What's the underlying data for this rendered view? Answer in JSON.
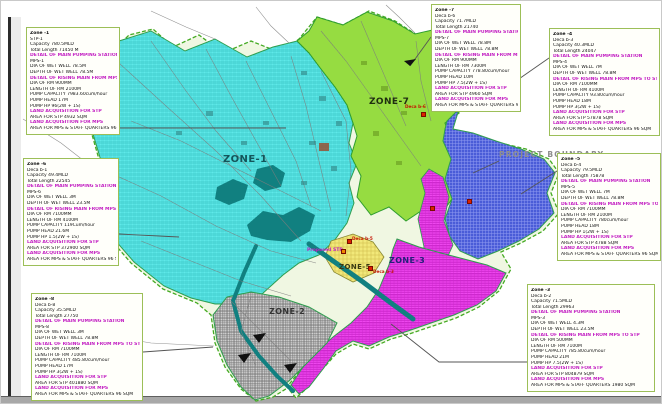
{
  "colors": {
    "zone_cyan": "#5fe9e9",
    "zone_green": "#a4e84c",
    "zone_blue": "#4a5cd8",
    "zone_magenta": "#ee46ee",
    "zone_yellow": "#f2e879",
    "zone_gray": "#cccccc",
    "water_teal": "#118080",
    "boundary_green": "#44aa22",
    "highlight_magenta": "#c21ec2",
    "marker_red": "#dd2200",
    "marker_orange": "#ee8800"
  },
  "map": {
    "project_boundary_label": "PROJECT BOUNDARY",
    "proposed_stp_label": "Proposed STP",
    "zone_labels": [
      {
        "id": "zone-1",
        "text": "ZONE-1"
      },
      {
        "id": "zone-7",
        "text": "ZONE-7"
      },
      {
        "id": "zone-2",
        "text": "ZONE-2"
      },
      {
        "id": "zone-3",
        "text": "ZONE-3"
      },
      {
        "id": "zone-5",
        "text": "ZONE-5"
      }
    ],
    "markers": [
      {
        "label": "Deca b-6",
        "type": "pump-station",
        "color": "#dd2200",
        "x": 420,
        "y": 111,
        "lx": 404,
        "ly": 103
      },
      {
        "label": "",
        "type": "pump-station",
        "color": "#dd2200",
        "x": 466,
        "y": 198,
        "lx": 0,
        "ly": 0
      },
      {
        "label": "",
        "type": "pump-station",
        "color": "#dd2200",
        "x": 429,
        "y": 205,
        "lx": 0,
        "ly": 0
      },
      {
        "label": "Deca b-3",
        "type": "pump-station",
        "color": "#dd2200",
        "x": 367,
        "y": 265,
        "lx": 372,
        "ly": 268
      },
      {
        "label": "Deca b-5",
        "type": "pump-station",
        "color": "#dd2200",
        "x": 346,
        "y": 238,
        "lx": 351,
        "ly": 235
      },
      {
        "label": "",
        "type": "proposed-stp",
        "color": "#ee8800",
        "x": 340,
        "y": 248,
        "lx": 0,
        "ly": 0
      }
    ]
  },
  "info_boxes": [
    {
      "id": "zone-1-info",
      "lines": [
        {
          "t": "Zone -1",
          "hl": false
        },
        {
          "t": "STP-1",
          "hl": false
        },
        {
          "t": "Capacity 780.5MLD",
          "hl": false
        },
        {
          "t": "Total Length 71450 M",
          "hl": false
        },
        {
          "t": "DETAIL OF MAIN PUMPING STATION",
          "hl": true
        },
        {
          "t": "MPS-1",
          "hl": false
        },
        {
          "t": "DIA OF WET WELL 78.5M",
          "hl": false
        },
        {
          "t": "DEPTH OF WET WELL 78.5M",
          "hl": false
        },
        {
          "t": "DETAIL OF RISING MAIN FROM MPS TO STP",
          "hl": true
        },
        {
          "t": "DIA OF RM 900MM",
          "hl": false
        },
        {
          "t": "LENGTH OF RM 2100M",
          "hl": false
        },
        {
          "t": "PUMP CAPACITY 7983.60cum/hour",
          "hl": false
        },
        {
          "t": "PUMP HEAD 17M",
          "hl": false
        },
        {
          "t": "PUMP HP 96(2W + 1S)",
          "hl": false
        },
        {
          "t": "LAND ACQUISITION FOR STP",
          "hl": true
        },
        {
          "t": "AREA FOR STP 4932 SQM",
          "hl": false
        },
        {
          "t": "LAND ACQUISITION FOR MPS",
          "hl": true
        },
        {
          "t": "AREA FOR MPS & STAFF QUARTERS 96 SQM",
          "hl": false
        }
      ]
    },
    {
      "id": "zone-7-info",
      "lines": [
        {
          "t": "Zone -7",
          "hl": false
        },
        {
          "t": "Deca b-6",
          "hl": false
        },
        {
          "t": "Capacity 71.7MLD",
          "hl": false
        },
        {
          "t": "Total Length 21740",
          "hl": false
        },
        {
          "t": "DETAIL OF MAIN PUMPING STATION",
          "hl": true
        },
        {
          "t": "MPS-7",
          "hl": false
        },
        {
          "t": "DIA OF WET WELL 78.8M",
          "hl": false
        },
        {
          "t": "DEPTH OF WET WELL 78.8M",
          "hl": false
        },
        {
          "t": "DETAIL OF RISING MAIN FROM MPS TO STP",
          "hl": true
        },
        {
          "t": "DIA OF RM 900MM",
          "hl": false
        },
        {
          "t": "LENGTH OF RM 7300M",
          "hl": false
        },
        {
          "t": "PUMP CAPACITY 778.80cum/hour",
          "hl": false
        },
        {
          "t": "PUMP HEAD 10M",
          "hl": false
        },
        {
          "t": "PUMP HP 7.5(2W + 1S)",
          "hl": false
        },
        {
          "t": "LAND ACQUISITION FOR STP",
          "hl": true
        },
        {
          "t": "AREA FOR STP 4960 SQM",
          "hl": false
        },
        {
          "t": "LAND ACQUISITION FOR MPS",
          "hl": true
        },
        {
          "t": "AREA FOR MPS & STAFF QUARTERS 96 SQM",
          "hl": false
        }
      ]
    },
    {
      "id": "zone-4-info",
      "lines": [
        {
          "t": "Zone -4",
          "hl": false
        },
        {
          "t": "Deca b-3",
          "hl": false
        },
        {
          "t": "Capacity 40.3MLD",
          "hl": false
        },
        {
          "t": "Total Length 24047",
          "hl": false
        },
        {
          "t": "DETAIL OF MAIN PUMPING STATION",
          "hl": true
        },
        {
          "t": "MPS-4",
          "hl": false
        },
        {
          "t": "DIA OF WET WELL 7M",
          "hl": false
        },
        {
          "t": "DEPTH OF WET WELL 78.8M",
          "hl": false
        },
        {
          "t": "DETAIL OF RISING MAIN FROM MPS TO STP",
          "hl": true
        },
        {
          "t": "DIA OF RM 7100MM",
          "hl": false
        },
        {
          "t": "LENGTH OF RM 4100M",
          "hl": false
        },
        {
          "t": "PUMP CAPACITY 93.80cum/hour",
          "hl": false
        },
        {
          "t": "PUMP HEAD 18M",
          "hl": false
        },
        {
          "t": "PUMP HP 3(2W + 1S)",
          "hl": false
        },
        {
          "t": "LAND ACQUISITION FOR STP",
          "hl": true
        },
        {
          "t": "AREA FOR STP 57878 SQM",
          "hl": false
        },
        {
          "t": "LAND ACQUISITION FOR MPS",
          "hl": true
        },
        {
          "t": "AREA FOR MPS & STAFF QUARTERS 96 SQM",
          "hl": false
        }
      ]
    },
    {
      "id": "zone-5-info",
      "lines": [
        {
          "t": "Zone -5",
          "hl": false
        },
        {
          "t": "Deca b-4",
          "hl": false
        },
        {
          "t": "Capacity 79.5MLD",
          "hl": false
        },
        {
          "t": "Total Length 75878",
          "hl": false
        },
        {
          "t": "DETAIL OF MAIN PUMPING STATION",
          "hl": true
        },
        {
          "t": "MPS-5",
          "hl": false
        },
        {
          "t": "DIA OF WET WELL 7M",
          "hl": false
        },
        {
          "t": "DEPTH OF WET WELL 78.8M",
          "hl": false
        },
        {
          "t": "DETAIL OF RISING MAIN FROM MPS TO STP",
          "hl": true
        },
        {
          "t": "DIA OF RM 7100MM",
          "hl": false
        },
        {
          "t": "LENGTH OF RM 2100M",
          "hl": false
        },
        {
          "t": "PUMP CAPACITY 780cum/hour",
          "hl": false
        },
        {
          "t": "PUMP HEAD 18M",
          "hl": false
        },
        {
          "t": "PUMP HP 1(2W + 1S)",
          "hl": false
        },
        {
          "t": "LAND ACQUISITION FOR STP",
          "hl": true
        },
        {
          "t": "AREA FOR STP 4788 SQM",
          "hl": false
        },
        {
          "t": "LAND ACQUISITION FOR MPS",
          "hl": true
        },
        {
          "t": "AREA FOR MPS & STAFF QUARTERS 96 SQM",
          "hl": false
        }
      ]
    },
    {
      "id": "zone-3-info",
      "lines": [
        {
          "t": "Zone -3",
          "hl": false
        },
        {
          "t": "Deca b-2",
          "hl": false
        },
        {
          "t": "Capacity 71.5MLD",
          "hl": false
        },
        {
          "t": "Total Length 29963",
          "hl": false
        },
        {
          "t": "DETAIL OF MAIN PUMPING STATION",
          "hl": true
        },
        {
          "t": "MPS-3",
          "hl": false
        },
        {
          "t": "DIA OF WET WELL 4.3M",
          "hl": false
        },
        {
          "t": "DEPTH OF WET WELL 23.5M",
          "hl": false
        },
        {
          "t": "DETAIL OF RISING MAIN FROM MPS TO STP",
          "hl": true
        },
        {
          "t": "DIA OF RM 500MM",
          "hl": false
        },
        {
          "t": "LENGTH OF RM 7100M",
          "hl": false
        },
        {
          "t": "PUMP CAPACITY 785.80cum/hour",
          "hl": false
        },
        {
          "t": "PUMP HEAD 21M",
          "hl": false
        },
        {
          "t": "PUMP HP 7.5(2W + 1S)",
          "hl": false
        },
        {
          "t": "LAND ACQUISITION FOR STP",
          "hl": true
        },
        {
          "t": "AREA FOR STP 804879 SQM",
          "hl": false
        },
        {
          "t": "LAND ACQUISITION FOR MPS",
          "hl": true
        },
        {
          "t": "AREA FOR MPS & STAFF QUARTERS 1980 SQM",
          "hl": false
        }
      ]
    },
    {
      "id": "zone-6-info",
      "lines": [
        {
          "t": "Zone -6",
          "hl": false
        },
        {
          "t": "Deca b-1",
          "hl": false
        },
        {
          "t": "Capacity 49.4MLD",
          "hl": false
        },
        {
          "t": "Total Length 22545",
          "hl": false
        },
        {
          "t": "DETAIL OF MAIN PUMPING STATION",
          "hl": true
        },
        {
          "t": "MPS-6",
          "hl": false
        },
        {
          "t": "DIA OF WET WELL 3M",
          "hl": false
        },
        {
          "t": "DEPTH OF WET WELL 23.5M",
          "hl": false
        },
        {
          "t": "DETAIL OF RISING MAIN FROM MPS TO STP",
          "hl": true
        },
        {
          "t": "DIA OF RM 7100MM",
          "hl": false
        },
        {
          "t": "LENGTH OF RM 4100M",
          "hl": false
        },
        {
          "t": "PUMP CAPACITY 119Cum/hour",
          "hl": false
        },
        {
          "t": "PUMP HEAD 21.6M",
          "hl": false
        },
        {
          "t": "PUMP HP 1.5(2W + 1S)",
          "hl": false
        },
        {
          "t": "LAND ACQUISITION FOR STP",
          "hl": true
        },
        {
          "t": "AREA FOR STP 372900 SQM",
          "hl": false
        },
        {
          "t": "LAND ACQUISITION FOR MPS",
          "hl": true
        },
        {
          "t": "AREA FOR MPS & STAFF QUARTERS 96 SQM",
          "hl": false
        }
      ]
    },
    {
      "id": "zone-8-info",
      "lines": [
        {
          "t": "Zone -8",
          "hl": false
        },
        {
          "t": "Deca b-8",
          "hl": false
        },
        {
          "t": "Capacity 35.5MLD",
          "hl": false
        },
        {
          "t": "Total Length 27750",
          "hl": false
        },
        {
          "t": "DETAIL OF MAIN PUMPING STATION",
          "hl": true
        },
        {
          "t": "MPS-8",
          "hl": false
        },
        {
          "t": "DIA OF WET WELL 3M",
          "hl": false
        },
        {
          "t": "DEPTH OF WET WELL 78.8M",
          "hl": false
        },
        {
          "t": "DETAIL OF RISING MAIN FROM MPS TO STP",
          "hl": true
        },
        {
          "t": "DIA OF RM 7100MM",
          "hl": false
        },
        {
          "t": "LENGTH OF RM 7100M",
          "hl": false
        },
        {
          "t": "PUMP CAPACITY 485.80cum/hour",
          "hl": false
        },
        {
          "t": "PUMP HEAD 17M",
          "hl": false
        },
        {
          "t": "PUMP HP 3(2W + 1S)",
          "hl": false
        },
        {
          "t": "LAND ACQUISITION FOR STP",
          "hl": true
        },
        {
          "t": "AREA FOR STP 401880 SQM",
          "hl": false
        },
        {
          "t": "LAND ACQUISITION FOR MPS",
          "hl": true
        },
        {
          "t": "AREA FOR MPS & STAFF QUARTERS 96 SQM",
          "hl": false
        }
      ]
    }
  ]
}
